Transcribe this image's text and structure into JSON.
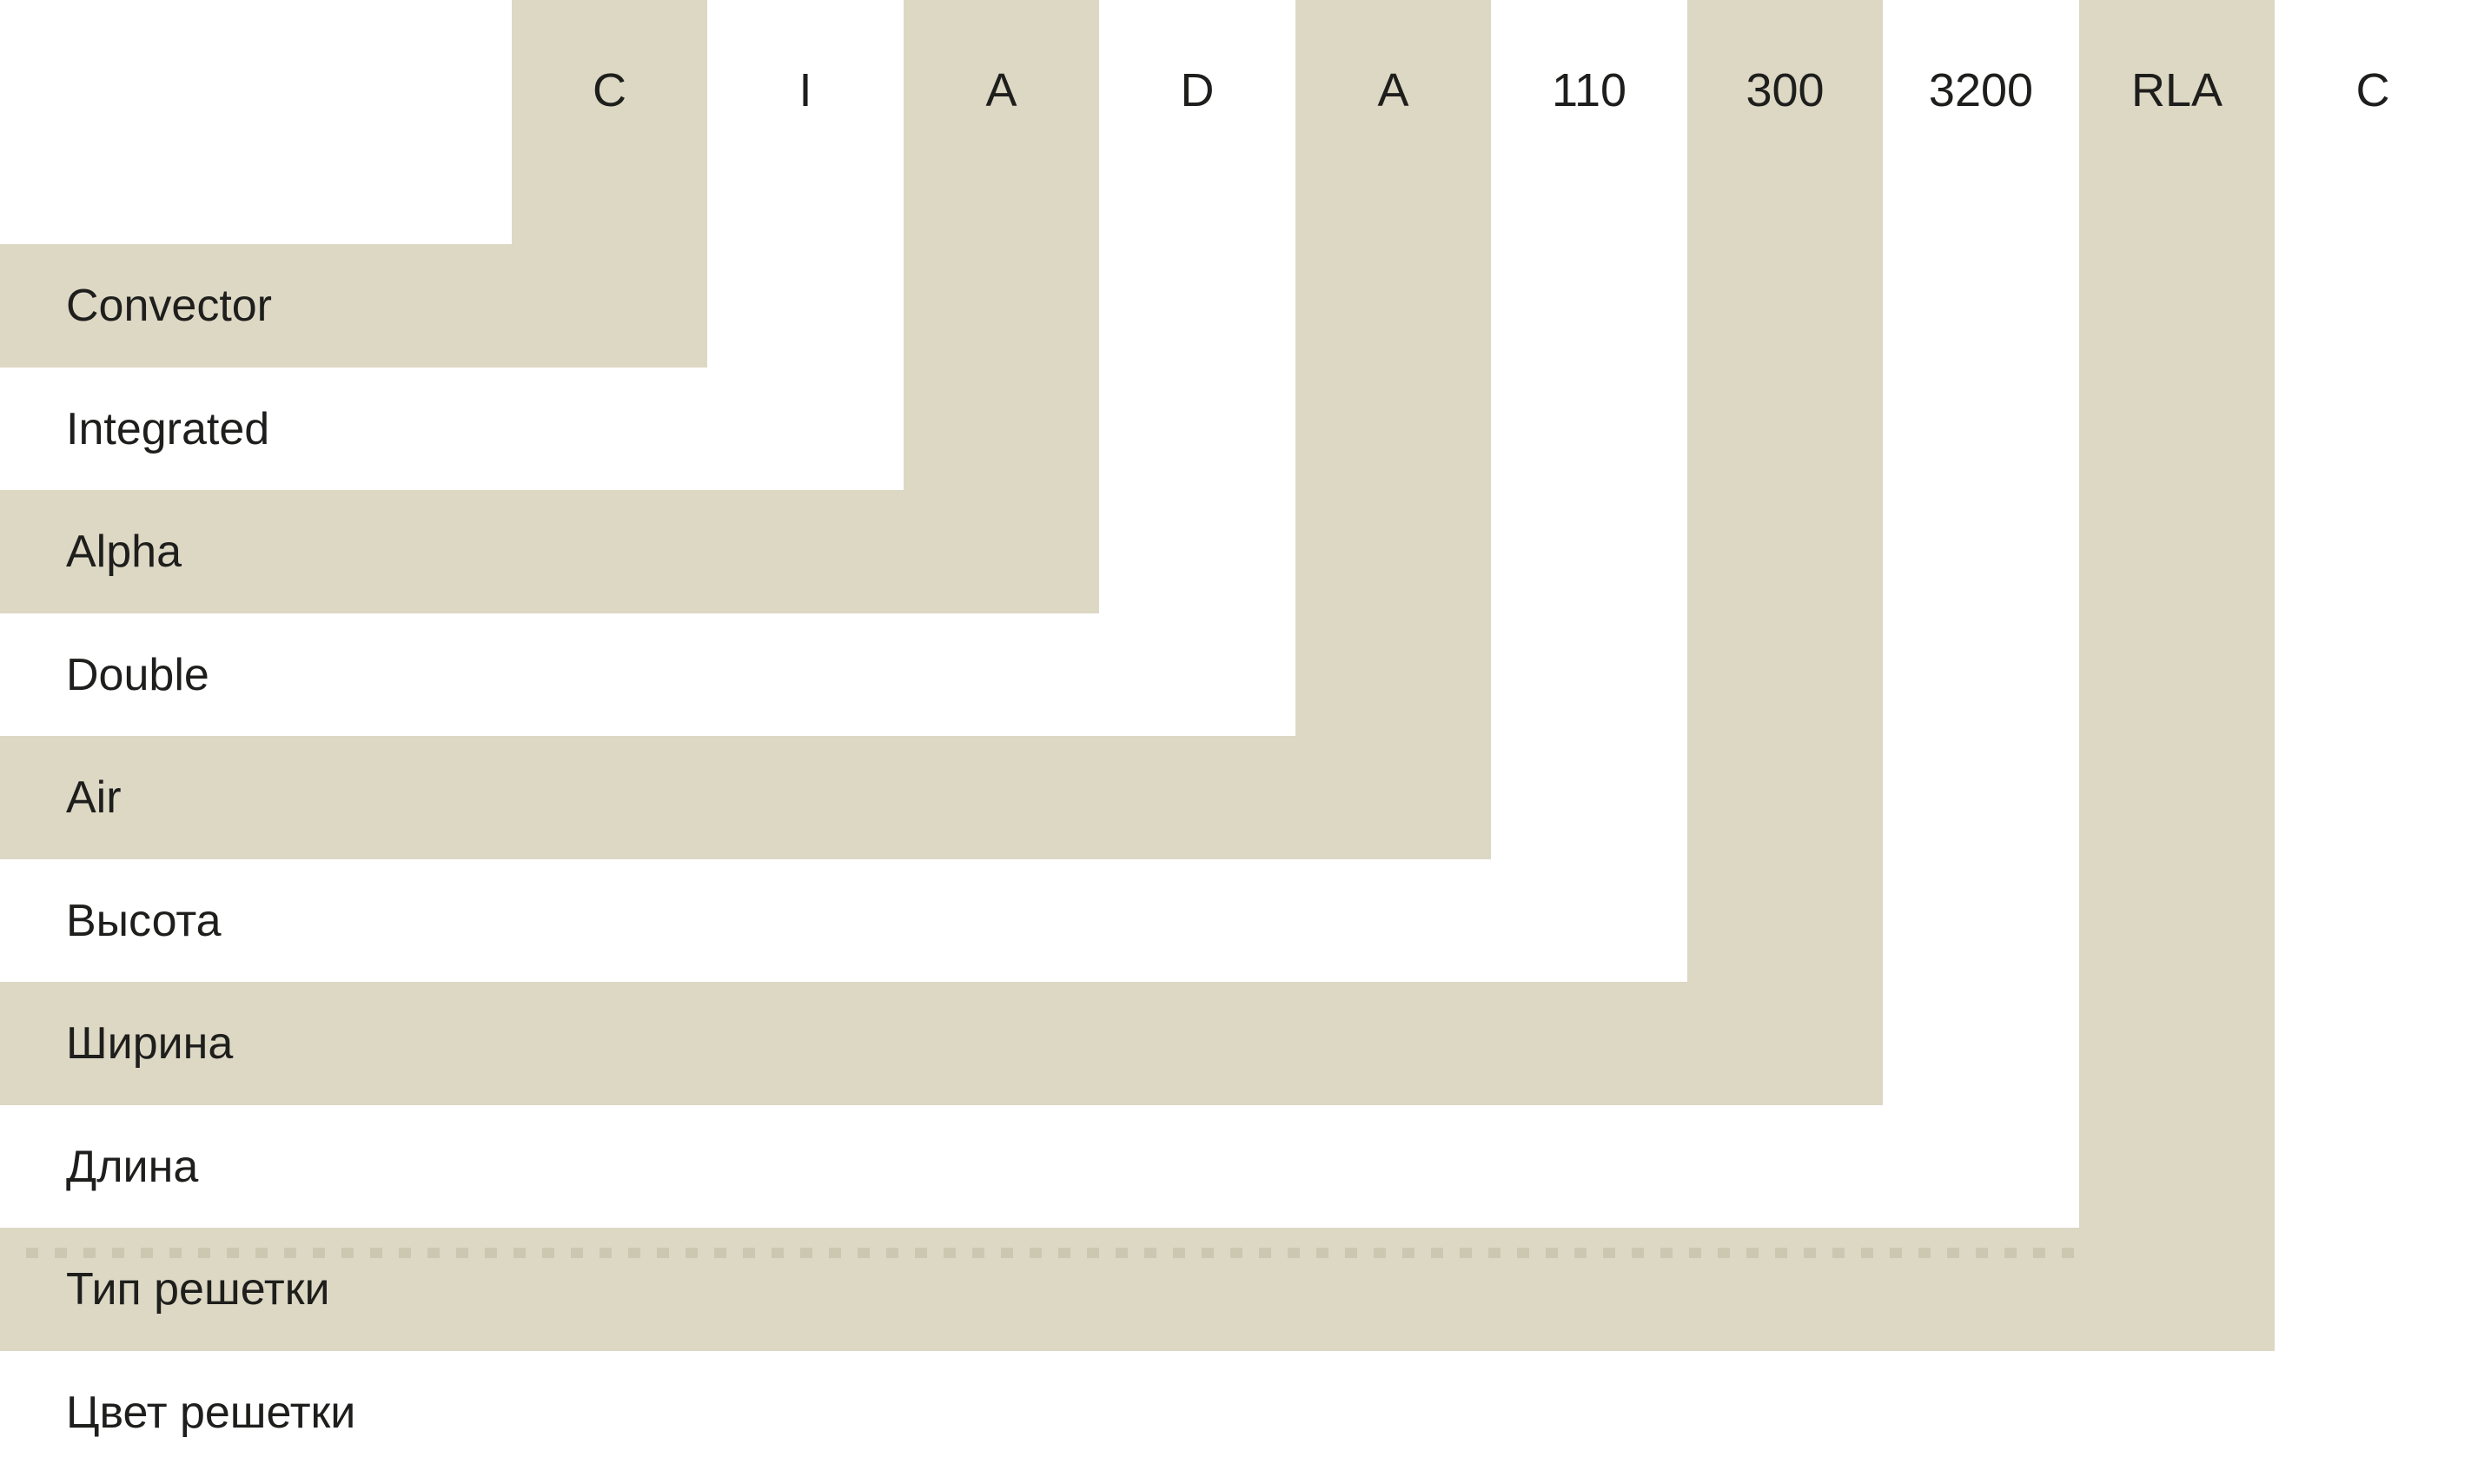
{
  "diagram_title": "Convector model code legend",
  "code_segments": [
    {
      "code": "C",
      "meaning": "Convector",
      "band": "beige"
    },
    {
      "code": "I",
      "meaning": "Integrated",
      "band": "white"
    },
    {
      "code": "A",
      "meaning": "Alpha",
      "band": "beige"
    },
    {
      "code": "D",
      "meaning": "Double",
      "band": "white"
    },
    {
      "code": "A",
      "meaning": "Air",
      "band": "beige"
    },
    {
      "code": "110",
      "meaning": "Высота",
      "band": "white"
    },
    {
      "code": "300",
      "meaning": "Ширина",
      "band": "beige"
    },
    {
      "code": "3200",
      "meaning": "Длина",
      "band": "white"
    },
    {
      "code": "RLA",
      "meaning": "Тип решетки",
      "band": "beige"
    },
    {
      "code": "C",
      "meaning": "Цвет решетки",
      "band": "white"
    }
  ],
  "colors": {
    "band_beige": "#dcd8c4",
    "background": "#ffffff",
    "text": "#1e1e1c",
    "dashed_texture": "rgba(125,122,92,0.18)"
  }
}
